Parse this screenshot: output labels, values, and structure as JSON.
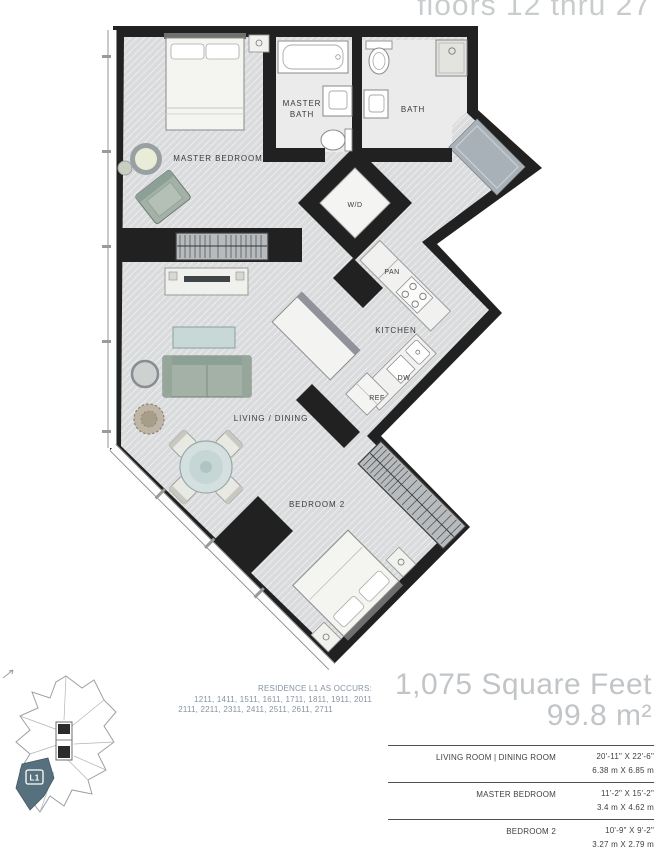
{
  "header": {
    "floors_label": "floors 12 thru 27"
  },
  "plan": {
    "labels": {
      "master_bedroom": "MASTER BEDROOM",
      "master_bath_line1": "MASTER",
      "master_bath_line2": "BATH",
      "bath": "BATH",
      "washer_dryer": "W/D",
      "pantry": "PAN",
      "kitchen": "KITCHEN",
      "dishwasher": "DW",
      "refrigerator": "REF",
      "living_dining": "LIVING / DINING",
      "bedroom2": "BEDROOM 2"
    }
  },
  "key_plan": {
    "unit_label": "L1"
  },
  "residence_note": {
    "line1": "RESIDENCE L1 AS OCCURS:",
    "line2": "1211, 1411, 1511, 1611, 1711, 1811, 1911, 2011",
    "line3": "2111, 2211, 2311, 2411, 2511, 2611, 2711"
  },
  "area": {
    "imperial": "1,075 Square Feet",
    "metric": "99.8 m²"
  },
  "dimensions_table": {
    "rows": [
      {
        "label": "LIVING ROOM | DINING ROOM",
        "imperial": "20'-11\" X 22'-6\"",
        "metric": "6.38 m X 6.85 m"
      },
      {
        "label": "MASTER BEDROOM",
        "imperial": "11'-2\" X 15'-2\"",
        "metric": "3.4 m X 4.62 m"
      },
      {
        "label": "BEDROOM 2",
        "imperial": "10'-9\" X 9'-2\"",
        "metric": "3.27 m X 2.79 m"
      }
    ]
  },
  "colors": {
    "wall": "#212121",
    "floor": "#d9dbdd",
    "bath_floor": "#ebebeb",
    "closet": "#b7bbbe",
    "unit_highlight": "#56717d",
    "headline": "#c2c5c7",
    "note_text": "#8593a3"
  }
}
